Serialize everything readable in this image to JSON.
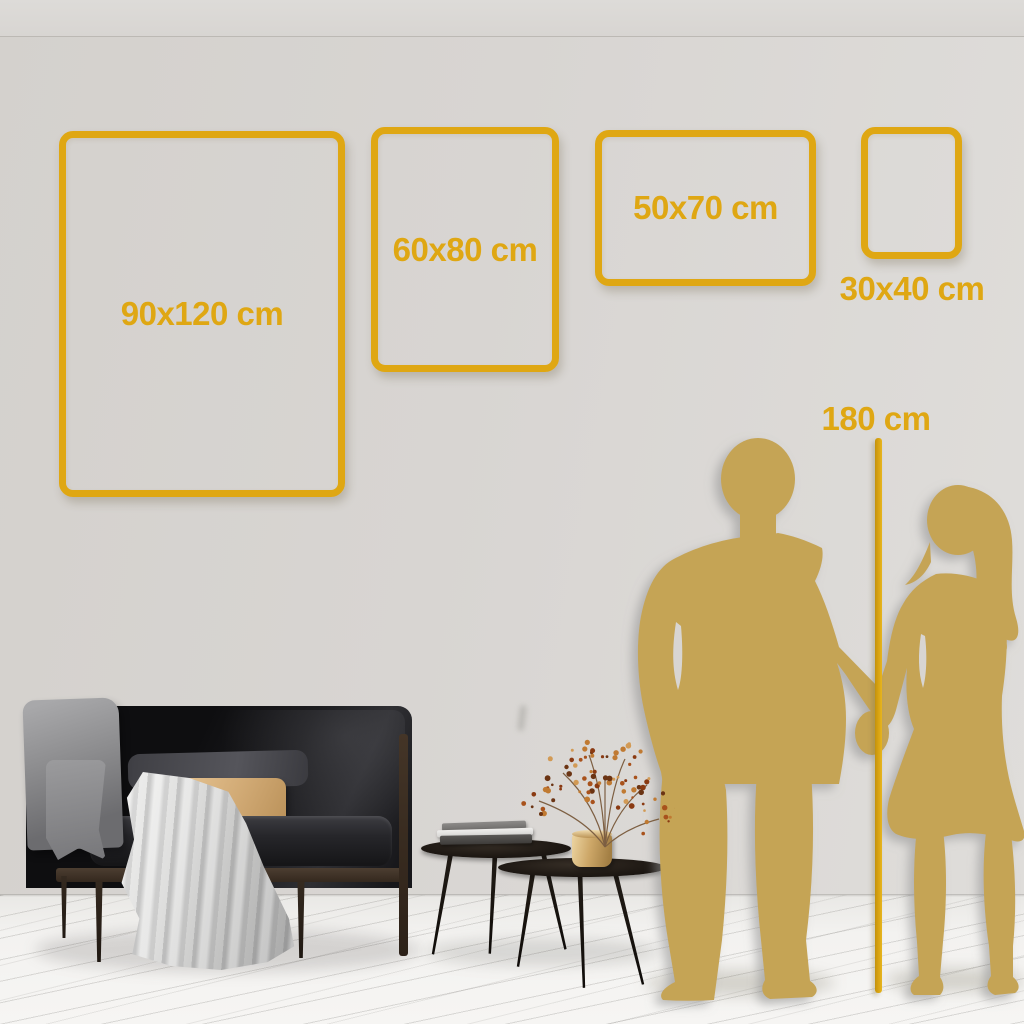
{
  "size_guide": {
    "unit": "cm",
    "frames": [
      {
        "label": "90x120 cm",
        "width_cm": 90,
        "height_cm": 120,
        "orientation": "portrait",
        "label_placement": "inside"
      },
      {
        "label": "60x80 cm",
        "width_cm": 60,
        "height_cm": 80,
        "orientation": "portrait",
        "label_placement": "inside"
      },
      {
        "label": "50x70 cm",
        "width_cm": 50,
        "height_cm": 70,
        "orientation": "landscape",
        "label_placement": "inside"
      },
      {
        "label": "30x40 cm",
        "width_cm": 30,
        "height_cm": 40,
        "orientation": "portrait",
        "label_placement": "below"
      }
    ],
    "height_reference": {
      "label": "180 cm",
      "value_cm": 180,
      "style": "vertical-line-beside-couple-silhouette"
    }
  },
  "colors": {
    "accent_gold": "#DFA713",
    "measure_line_gold": "#D5A00F",
    "silhouette_gold": "#C5A455",
    "wall_gray": "#D8D5D2",
    "floor_white": "#F3F2F0"
  },
  "scene": {
    "objects": [
      "dark-velvet-sofa",
      "gray-blanket",
      "white-draped-cloth",
      "beige-lumbar-pillow",
      "nesting-coffee-tables",
      "stacked-books",
      "brass-vase-with-dried-branch",
      "man-and-woman-silhouette-holding-hands",
      "white-plank-floor"
    ]
  }
}
